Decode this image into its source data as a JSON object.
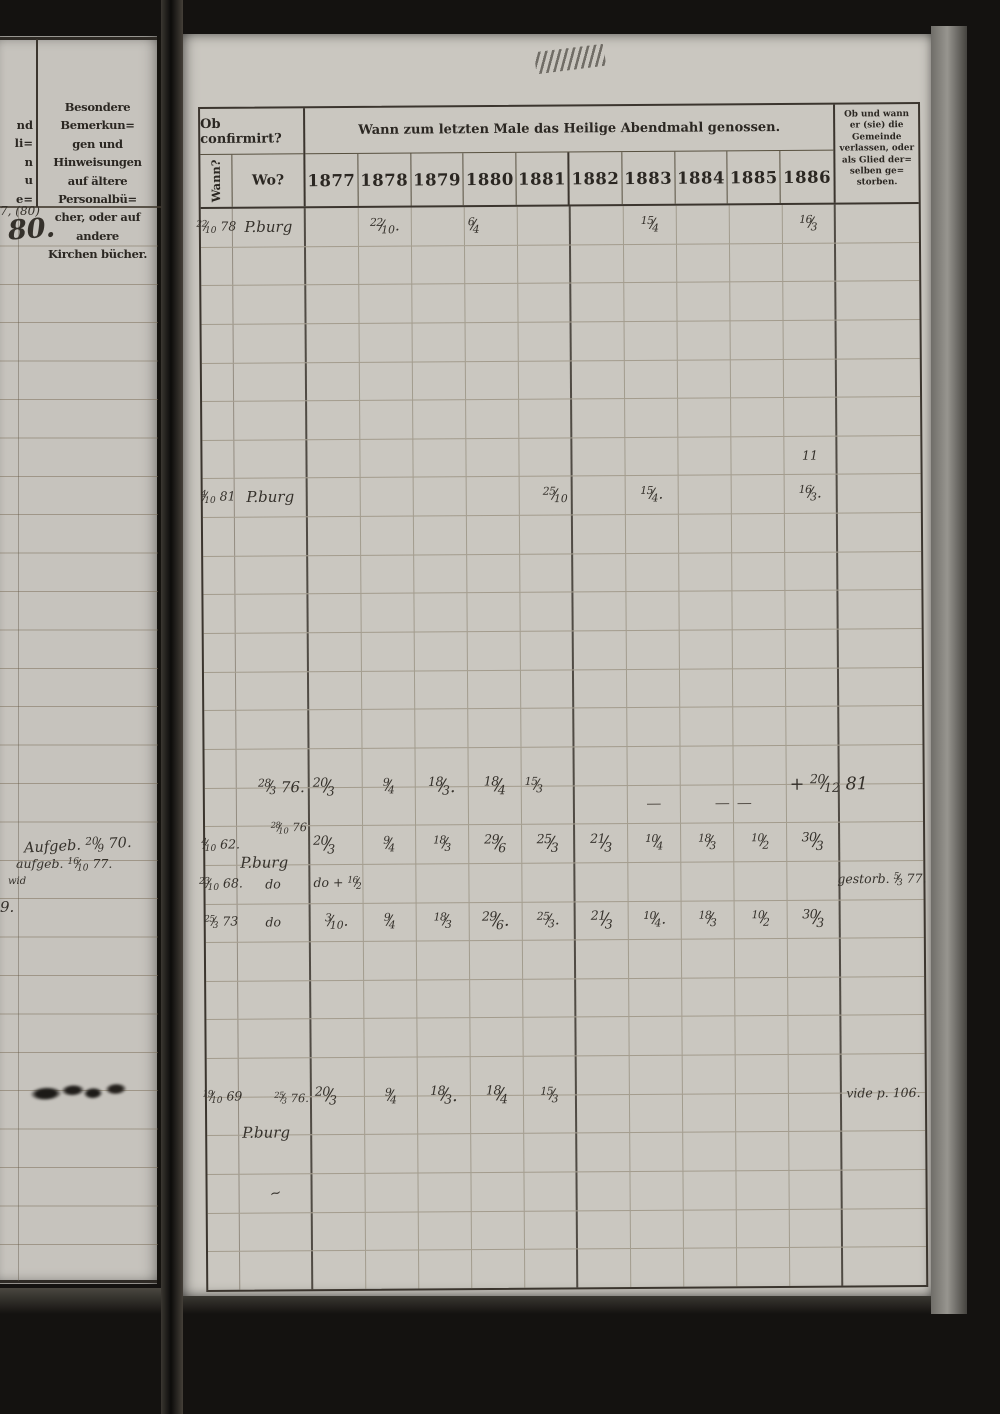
{
  "colors": {
    "photo_background": "#141210",
    "paper_left": "#c6c3bd",
    "paper_right": "#cac7c0",
    "print_ink": "#2b2722",
    "handwriting_ink": "#35312b"
  },
  "left_page": {
    "margin_fragments": [
      "nd",
      "li=",
      "n",
      "u",
      "e="
    ],
    "header_lines": [
      "Besondere Bemerkun=",
      "gen und Hinweisungen",
      "auf ältere Personalbü=",
      "cher, oder auf andere",
      "Kirchen bücher."
    ],
    "entries": {
      "ref_small": "7, (80)",
      "ref_big": "80.",
      "banns_1": "Aufgeb. 20/9 70.",
      "banns_2": "aufgeb. 16/10 77.",
      "fragment": "wid",
      "partial_number": "9."
    }
  },
  "right_page": {
    "header": {
      "confirmed": "Ob confirmirt?",
      "when": "Wann?",
      "where": "Wo?",
      "communion": "Wann zum letzten Male das Heilige Abendmahl genossen.",
      "years": [
        "1877",
        "1878",
        "1879",
        "1880",
        "1881",
        "1882",
        "1883",
        "1884",
        "1885",
        "1886"
      ],
      "departed_lines": [
        "Ob und wann",
        "er (sie) die",
        "Gemeinde",
        "verlassen, oder",
        "als Glied der=",
        "selben ge=",
        "storben."
      ]
    },
    "entries": [
      {
        "r": 0,
        "c": "wann",
        "t": "22/10 78",
        "cls": "small"
      },
      {
        "r": 0,
        "c": "wo",
        "t": "P.burg"
      },
      {
        "r": 0,
        "c": "y1878",
        "t": "22/10."
      },
      {
        "r": 0,
        "c": "y1880",
        "t": "6/4",
        "cls": "left"
      },
      {
        "r": 0,
        "c": "y1883",
        "t": "15/4"
      },
      {
        "r": 0,
        "c": "y1886",
        "t": "16/3"
      },
      {
        "r": 6,
        "c": "y1886",
        "t": "11",
        "cls": "small"
      },
      {
        "r": 7,
        "c": "wann",
        "t": "4/10 81",
        "cls": "small"
      },
      {
        "r": 7,
        "c": "wo",
        "t": "P.burg"
      },
      {
        "r": 7,
        "c": "y1881",
        "t": "25/10",
        "cls": "right"
      },
      {
        "r": 7,
        "c": "y1883",
        "t": "15/4."
      },
      {
        "r": 7,
        "c": "y1886",
        "t": "16/3."
      },
      {
        "r": 15,
        "c": "wo",
        "t": "28/3 76.",
        "cls": "right high"
      },
      {
        "r": 15,
        "c": "y1877",
        "t": "20/3",
        "cls": "left high big"
      },
      {
        "r": 15,
        "c": "y1878",
        "t": "9/4",
        "cls": "high"
      },
      {
        "r": 15,
        "c": "y1879",
        "t": "18/3.",
        "cls": "high big"
      },
      {
        "r": 15,
        "c": "y1880",
        "t": "18/4",
        "cls": "high big"
      },
      {
        "r": 15,
        "c": "y1881",
        "t": "15/3",
        "cls": "left high"
      },
      {
        "r": 15,
        "c": "y1883",
        "t": "—",
        "cls": "dash"
      },
      {
        "r": 15,
        "c": "y1884",
        "t": "—",
        "cls": "dash right"
      },
      {
        "r": 15,
        "c": "y1885",
        "t": "—",
        "cls": "dash left"
      },
      {
        "r": 15,
        "c": "y1886",
        "t": "+ 20/12 81",
        "cls": "left wide high big"
      },
      {
        "r": 16,
        "c": "wann",
        "t": "4/10 62.",
        "cls": "small"
      },
      {
        "r": 16,
        "c": "wo",
        "t": "28/10 76",
        "cls": "above"
      },
      {
        "r": 16,
        "c": "wo",
        "t": "P.burg",
        "cls": "below"
      },
      {
        "r": 16,
        "c": "y1877",
        "t": "20/3",
        "cls": "left big"
      },
      {
        "r": 16,
        "c": "y1878",
        "t": "9/4"
      },
      {
        "r": 16,
        "c": "y1879",
        "t": "18/3"
      },
      {
        "r": 16,
        "c": "y1880",
        "t": "29/6",
        "cls": "big"
      },
      {
        "r": 16,
        "c": "y1881",
        "t": "25/3",
        "cls": "big"
      },
      {
        "r": 16,
        "c": "y1882",
        "t": "21/3",
        "cls": "big"
      },
      {
        "r": 16,
        "c": "y1883",
        "t": "10/4"
      },
      {
        "r": 16,
        "c": "y1884",
        "t": "18/3"
      },
      {
        "r": 16,
        "c": "y1885",
        "t": "10/2"
      },
      {
        "r": 16,
        "c": "y1886",
        "t": "30/3",
        "cls": "big"
      },
      {
        "r": 17,
        "c": "wann",
        "t": "23/10 68.",
        "cls": "small"
      },
      {
        "r": 17,
        "c": "wo",
        "t": "do",
        "cls": "small"
      },
      {
        "r": 17,
        "c": "y1877",
        "t": "do + 16/2",
        "cls": "left wide small"
      },
      {
        "r": 17,
        "c": "rem",
        "t": "gestorb. 5/3 77.",
        "cls": "small"
      },
      {
        "r": 18,
        "c": "wann",
        "t": "25/3 73",
        "cls": "small"
      },
      {
        "r": 18,
        "c": "wo",
        "t": "do",
        "cls": "small"
      },
      {
        "r": 18,
        "c": "y1877",
        "t": "3/10."
      },
      {
        "r": 18,
        "c": "y1878",
        "t": "9/4"
      },
      {
        "r": 18,
        "c": "y1879",
        "t": "18/3"
      },
      {
        "r": 18,
        "c": "y1880",
        "t": "29/6.",
        "cls": "big"
      },
      {
        "r": 18,
        "c": "y1881",
        "t": "25/3."
      },
      {
        "r": 18,
        "c": "y1882",
        "t": "21/3",
        "cls": "big"
      },
      {
        "r": 18,
        "c": "y1883",
        "t": "10/4."
      },
      {
        "r": 18,
        "c": "y1884",
        "t": "18/3"
      },
      {
        "r": 18,
        "c": "y1885",
        "t": "10/2"
      },
      {
        "r": 18,
        "c": "y1886",
        "t": "30/3",
        "cls": "big"
      },
      {
        "r": 23,
        "c": "wann",
        "t": "19/10 69",
        "cls": "small high"
      },
      {
        "r": 23,
        "c": "wo",
        "t": "25/3 76.",
        "cls": "above"
      },
      {
        "r": 23,
        "c": "wo",
        "t": "P.burg",
        "cls": "below"
      },
      {
        "r": 23,
        "c": "y1877",
        "t": "20/3",
        "cls": "left big high"
      },
      {
        "r": 23,
        "c": "y1878",
        "t": "9/4",
        "cls": "high"
      },
      {
        "r": 23,
        "c": "y1879",
        "t": "18/3.",
        "cls": "big high"
      },
      {
        "r": 23,
        "c": "y1880",
        "t": "18/4",
        "cls": "big high"
      },
      {
        "r": 23,
        "c": "y1881",
        "t": "15/3",
        "cls": "high"
      },
      {
        "r": 23,
        "c": "rem",
        "t": "vide p. 106.",
        "cls": "small high"
      },
      {
        "r": 25,
        "c": "wo",
        "t": "~",
        "cls": "mark"
      }
    ]
  }
}
